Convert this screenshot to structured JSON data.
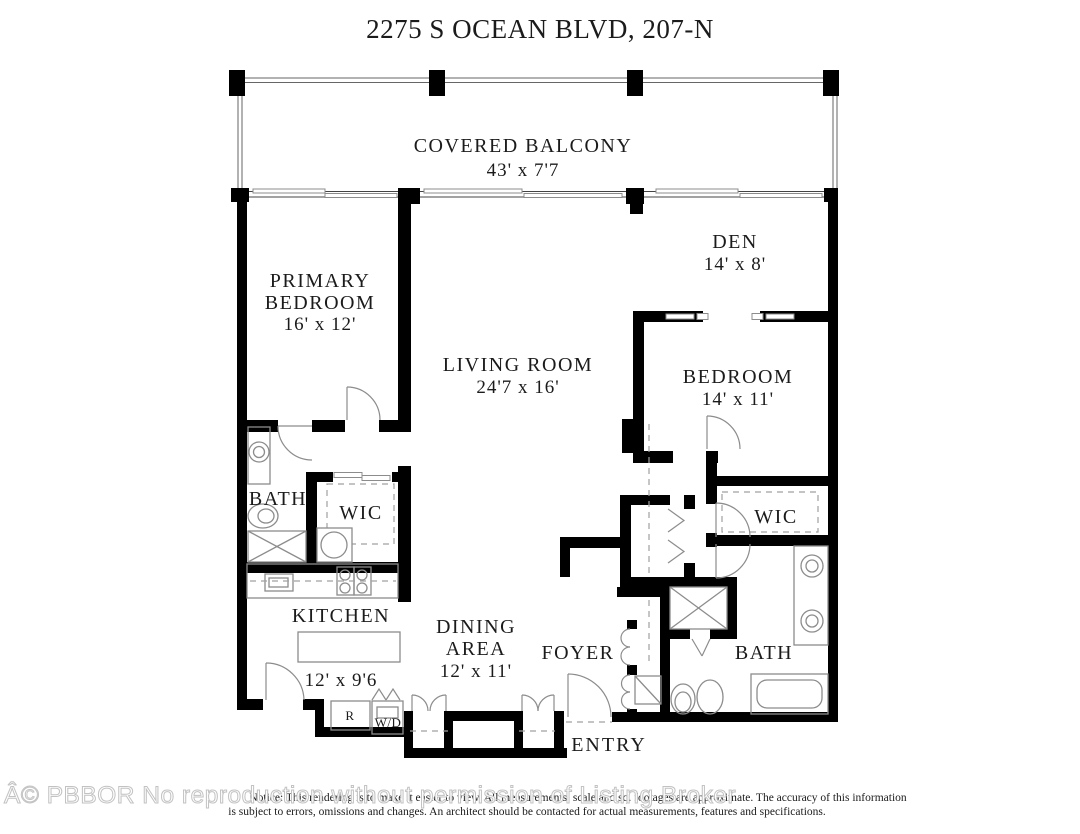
{
  "page": {
    "title": "2275 S OCEAN BLVD, 207-N"
  },
  "rooms": {
    "covered_balcony": {
      "name": "COVERED BALCONY",
      "dims": "43' x 7'7"
    },
    "primary_bedroom": {
      "line1": "PRIMARY",
      "line2": "BEDROOM",
      "dims": "16' x 12'"
    },
    "den": {
      "name": "DEN",
      "dims": "14' x 8'"
    },
    "living_room": {
      "name": "LIVING ROOM",
      "dims": "24'7 x 16'"
    },
    "bedroom": {
      "name": "BEDROOM",
      "dims": "14' x 11'"
    },
    "bath_left": {
      "name": "BATH"
    },
    "wic_left": {
      "name": "WIC"
    },
    "kitchen": {
      "name": "KITCHEN",
      "dims": "12' x 9'6"
    },
    "dining_area": {
      "line1": "DINING",
      "line2": "AREA",
      "dims": "12' x 11'"
    },
    "foyer": {
      "name": "FOYER"
    },
    "wic_right": {
      "name": "WIC"
    },
    "bath_right": {
      "name": "BATH"
    },
    "entry": {
      "name": "ENTRY"
    }
  },
  "appliances": {
    "refrigerator": "R",
    "washer_dryer": "W/D"
  },
  "footer": {
    "watermark": "Â© PBBOR No reproduction without permission of Listing Broker",
    "disclaimer_line1": "Notice: This rendering is to make it easier to view. All measurements, scale and sq. footages are approximate. The accuracy of this information",
    "disclaimer_line2": "is subject to errors, omissions and changes. An architect should be contacted for actual measurements, features and specifications."
  },
  "colors": {
    "wall": "#000000",
    "fixture_line": "#8c8c8c",
    "text": "#1b1b1b",
    "watermark_outline": "#c2c2c2",
    "background": "#ffffff"
  }
}
